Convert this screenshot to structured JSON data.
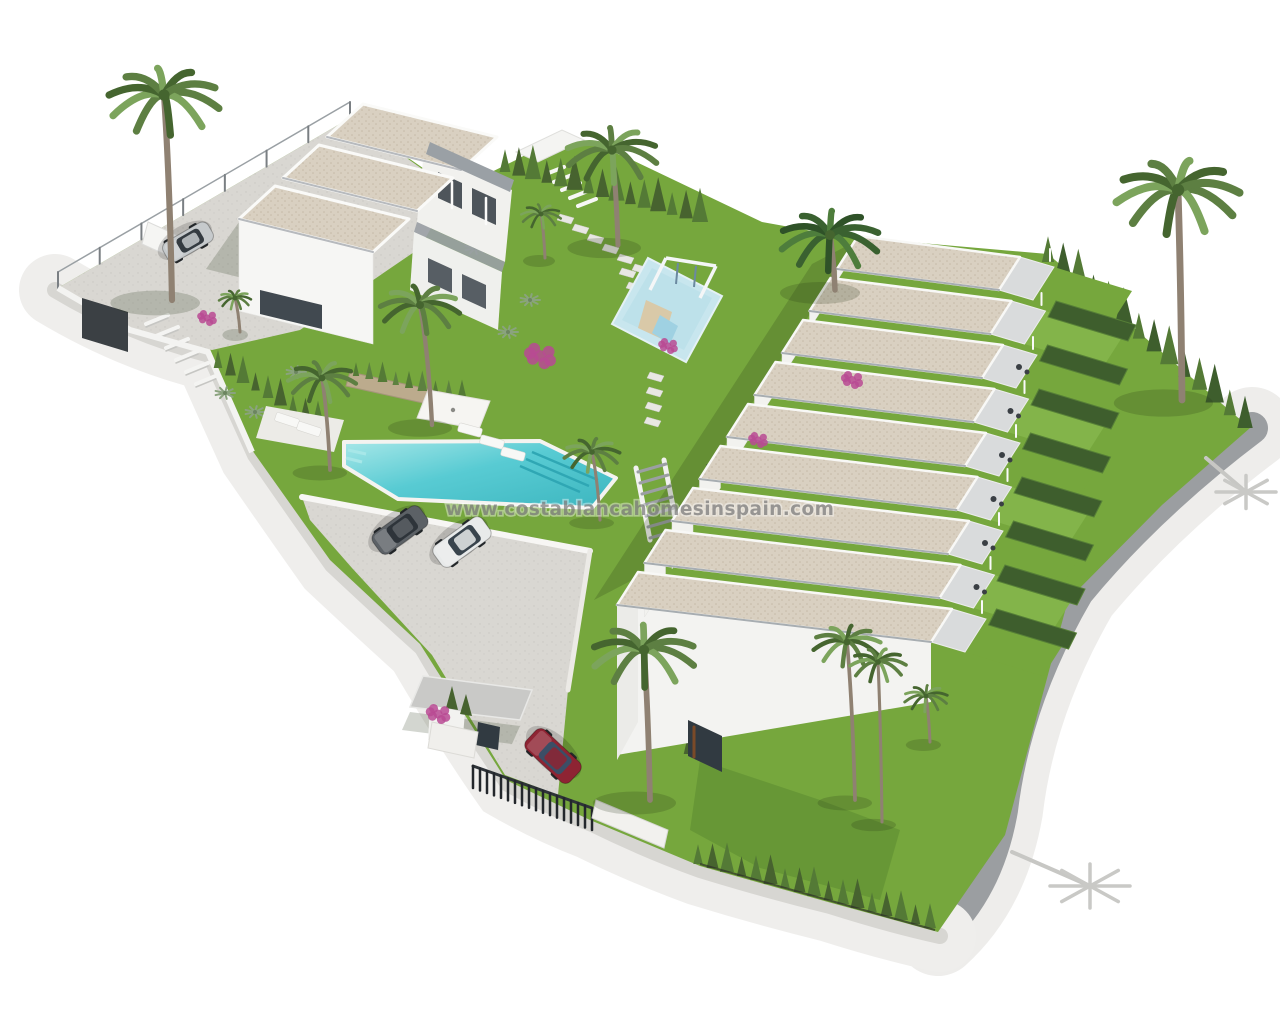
{
  "watermark": {
    "text": "www.costablancahomesinspain.com"
  },
  "scene": {
    "description": "Aerial 3D architectural render of a new-build residential complex on a white background",
    "villa_block_units": 3,
    "townhouse_row_units": 9,
    "palm_tree_count": 12,
    "sun_lounger_count": 5,
    "amenities": [
      "communal swimming pool",
      "children playground",
      "sun loungers",
      "parasol",
      "parking area",
      "entrance gate"
    ],
    "vehicles": [
      {
        "name": "silver-car-top-parking",
        "color": "#c6cacc"
      },
      {
        "name": "grey-car-parking",
        "color": "#5c6166"
      },
      {
        "name": "white-car-parking",
        "color": "#e8eaea"
      },
      {
        "name": "red-car-entrance",
        "color": "#8e2433"
      }
    ],
    "vegetation": [
      "palm trees",
      "cypress hedges",
      "bougainvillea",
      "lawns",
      "banana plants"
    ]
  },
  "palette": {
    "background": "#ffffff",
    "lawn": "#76a73d",
    "lawn_light": "#83b44a",
    "lawn_dark": "#4e7a2a",
    "hedge": "#3e5e2d",
    "hedge_light": "#567f37",
    "conifer": "#47632f",
    "roof": "#d9d0c1",
    "roof_grain": "#c5baa7",
    "wall": "#f5f5f3",
    "wall_shade": "#e6e6e3",
    "slab": "#9aa0a5",
    "glass": "#313a41",
    "pool": "#58cbd3",
    "pool_light": "#a7e7e8",
    "pool_dark": "#2fa7b4",
    "paving": "#d9d7d2",
    "road": "#efeeec",
    "sidewalk": "#d7d6d2",
    "asphalt": "#9b9ea1",
    "playground_pad": "#c8e6ee",
    "palm_trunk": "#8f8172",
    "frond": "#5d7f42",
    "frond_light": "#7ca45c",
    "frond_dark": "#45652f",
    "bougainvillea": "#b84a93",
    "fence": "#2c3136",
    "shadow": "rgba(35,52,20,0.20)",
    "watermark_color": "#898989"
  }
}
